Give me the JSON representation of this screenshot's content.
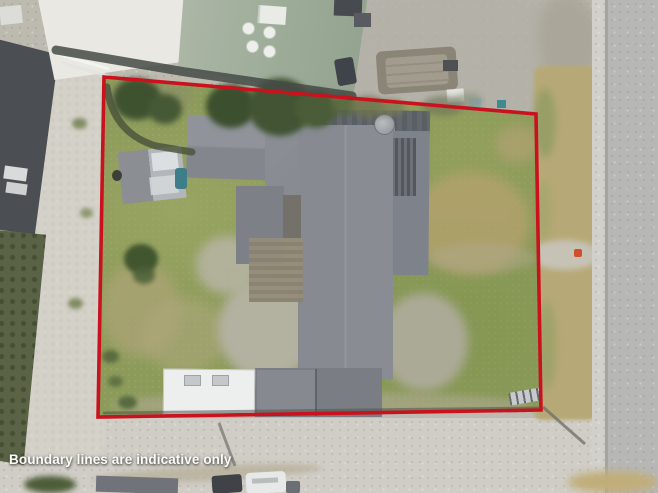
{
  "caption": {
    "text": "Boundary lines are indicative only"
  },
  "boundary": {
    "color": "#c9121e",
    "width_px": 3.6,
    "vertices_px": [
      [
        104,
        77
      ],
      [
        536,
        114
      ],
      [
        541,
        410
      ],
      [
        98,
        417
      ]
    ]
  },
  "scene": {
    "type": "aerial-property-photo",
    "objects": [
      "main-house-roof",
      "garage-roof",
      "caravan",
      "garden-shed",
      "wood-deck",
      "satellite-dish",
      "boat-trailer",
      "green-roof-building",
      "white-roof-building",
      "neighbor-roofs",
      "left-driveway",
      "lawn",
      "grass-verge",
      "footpath",
      "road-right",
      "road-bottom",
      "trees",
      "mailbox",
      "ladder",
      "vehicles"
    ]
  }
}
